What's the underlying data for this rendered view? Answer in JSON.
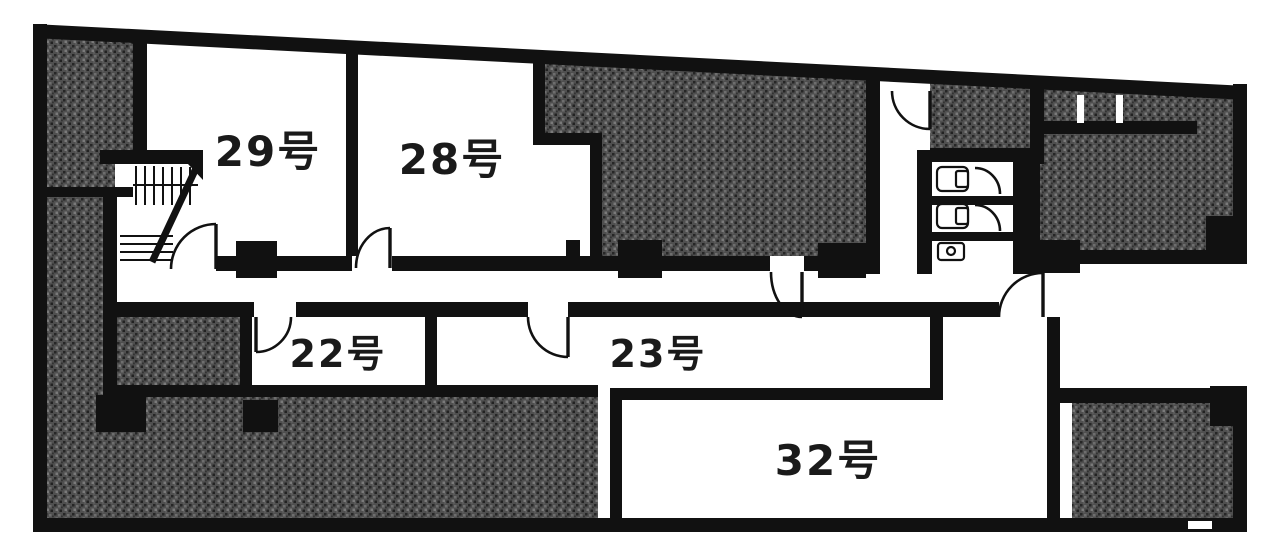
{
  "plan": {
    "type": "building-floor-plan",
    "rooms": [
      {
        "id": "29",
        "label": "29号"
      },
      {
        "id": "28",
        "label": "28号"
      },
      {
        "id": "22",
        "label": "22号"
      },
      {
        "id": "23",
        "label": "23号"
      },
      {
        "id": "32",
        "label": "32号"
      }
    ],
    "fixtures": {
      "stairwell": "staircase",
      "toilet_stalls": 2,
      "sink": 1,
      "door_arcs": 9
    },
    "colors": {
      "wall": "#111111",
      "hatch_base": "#4f4f4f",
      "hatch_dark": "#262626",
      "hatch_light": "#7a7a7a",
      "room_fill": "#ffffff",
      "background": "#ffffff"
    }
  }
}
